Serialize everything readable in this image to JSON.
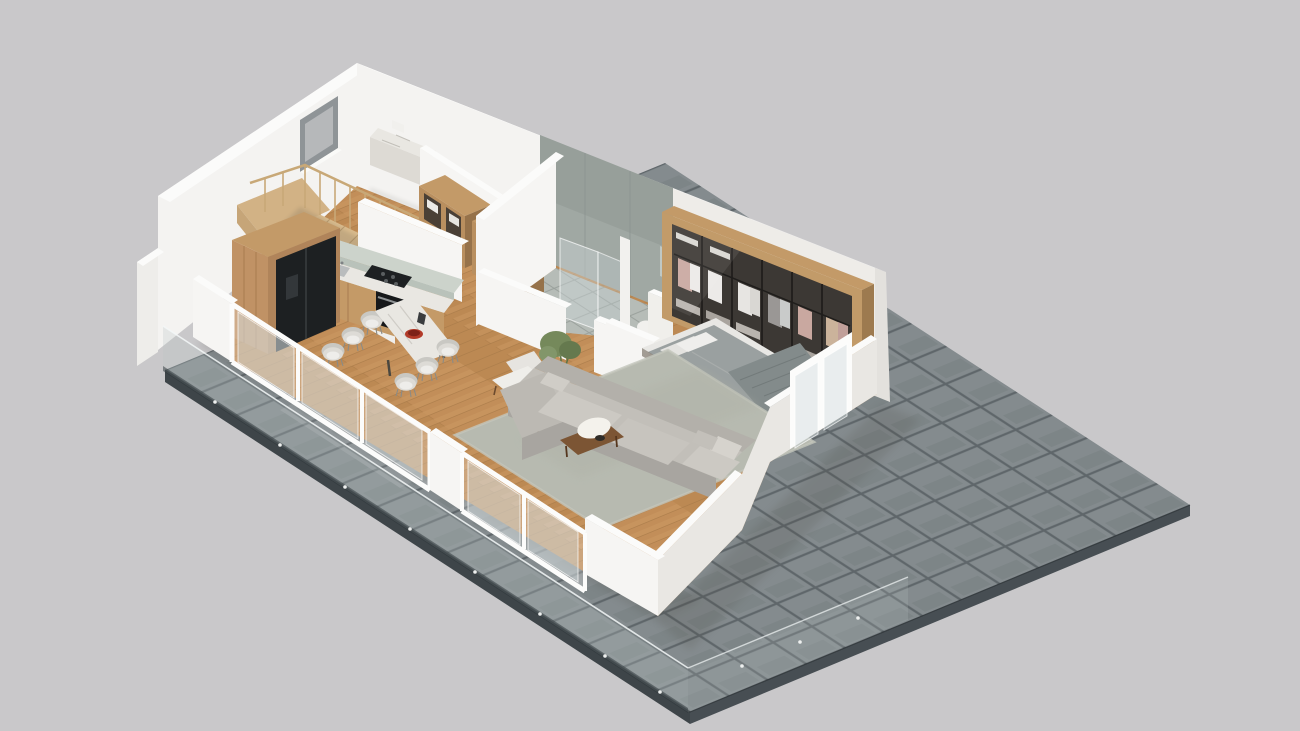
{
  "meta": {
    "description": "3D isometric cutaway render of an apartment floor plan on a gray backdrop, building set on a dark tiled terrace with frameless glass railing",
    "view": "axonometric cutaway, walls sliced at half height on viewer-facing sides",
    "background_plain": true,
    "visible_text": ""
  },
  "palette": {
    "background": "#c7c6c8",
    "wall_white": "#f4f3f1",
    "wall_top": "#fbfbfa",
    "wall_shade": "#e9e7e3",
    "terrace_tile": "#868d90",
    "terrace_grout": "#636a6e",
    "terrace_side": "#3e4549",
    "wood_floor": "#c28e59",
    "wood_floor_line": "#a87a48",
    "wood_cabinet": "#c39a68",
    "wood_cabinet_dark": "#9d7a4f",
    "wood_stairs": "#d9bb8d",
    "marble": "#e9e7e2",
    "marble_green": "#ccd3cb",
    "appliance_black": "#1d2022",
    "sofa_gray": "#c2bfb9",
    "rug_sage": "#b7bab0",
    "bed_gray": "#9aa0a0",
    "bathroom_wall": "#a0a8a3",
    "bathroom_floor": "#b6bcb7",
    "wardrobe_interior": "#3c3834",
    "glass": "#b9c4c4",
    "plant_green": "#75895b",
    "accent_red": "#b23a28",
    "chair_fabric": "#dddbd6"
  },
  "rooms": [
    {
      "id": "terrace",
      "label": "Terrace with dark tile paving and glass railing"
    },
    {
      "id": "staircase",
      "label": "Wooden staircase with balustrade"
    },
    {
      "id": "utility",
      "label": "Utility room with window and marble counter"
    },
    {
      "id": "corridor-closet",
      "label": "Corridor with open wooden shelving units"
    },
    {
      "id": "kitchen",
      "label": "Kitchen with pantry, fridge, cooktop, oven, sink"
    },
    {
      "id": "dining",
      "label": "Dining area with marble table and six chairs"
    },
    {
      "id": "living",
      "label": "Living room with L-sofa, rug, armchairs, coffee table, plant"
    },
    {
      "id": "bathroom",
      "label": "Bathroom with glass shower, toilet and vanity"
    },
    {
      "id": "bedroom",
      "label": "Bedroom with double bed and glazed wardrobe wall"
    }
  ],
  "furniture": [
    {
      "room": "staircase",
      "item": "wood stairs with landing and spindle railing"
    },
    {
      "room": "utility",
      "item": "floating marble laundry counter with towels"
    },
    {
      "room": "corridor-closet",
      "item": "two open oak shelf cabinets with linens"
    },
    {
      "room": "kitchen",
      "item": "tall oak pantry with built-in black fridge"
    },
    {
      "room": "kitchen",
      "item": "marble worktop with black cooktop, oven and steel sink"
    },
    {
      "room": "dining",
      "item": "marble dining table, red fruit bowl, six gray barrel chairs"
    },
    {
      "room": "living",
      "item": "gray L-shaped sofa with cushions"
    },
    {
      "room": "living",
      "item": "sage green area rug"
    },
    {
      "room": "living",
      "item": "two wood-frame armchairs and side table"
    },
    {
      "room": "living",
      "item": "coffee table with white sheepskin stool"
    },
    {
      "room": "living",
      "item": "potted plant in white vase"
    },
    {
      "room": "bathroom",
      "item": "glass shower enclosure, toilet, vanity with mirror"
    },
    {
      "room": "bedroom",
      "item": "double bed, gray duvet, white pillows, knit throw"
    },
    {
      "room": "bedroom",
      "item": "six-door glazed wardrobe with hanging clothes"
    },
    {
      "room": "terrace",
      "item": "frameless glass balustrade with point fixings"
    }
  ],
  "openings": {
    "window_back_wall": 1,
    "sliding_glass_doors_front": 2,
    "bedroom_glass_door": 1
  }
}
